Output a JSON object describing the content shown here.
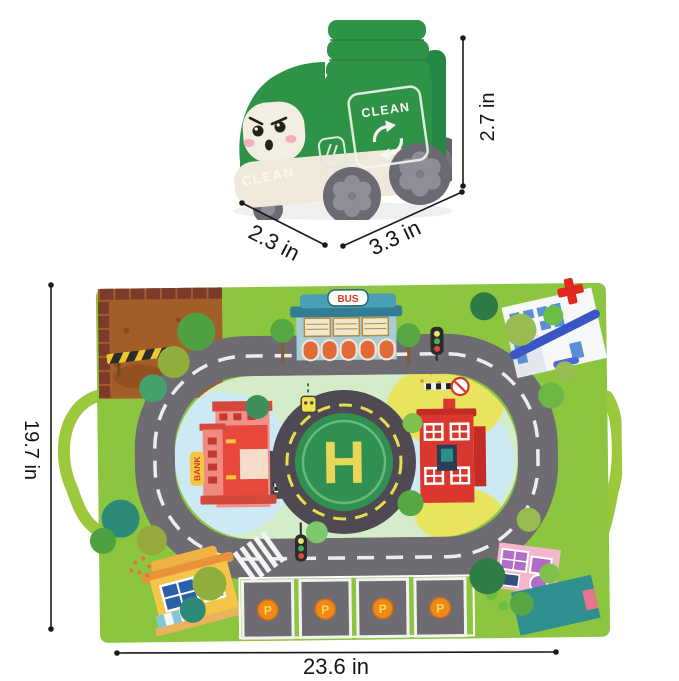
{
  "truck": {
    "front_label": "CLEAN",
    "panel_label": "CLEAN",
    "body_color": "#2E9247",
    "face_color": "#F3EEE2",
    "dims": {
      "height": "2.7 in",
      "depth": "2.3 in",
      "length": "3.3 in"
    }
  },
  "mat": {
    "signs": {
      "bus": "BUS",
      "bank": "BANK",
      "helipad": "H"
    },
    "parking_labels": [
      "P",
      "P",
      "P",
      "P"
    ],
    "colors": {
      "base": "#8CC63E",
      "road": "#6F6B73",
      "helipad_green": "#2F9052",
      "helipad_pad": "#4E4952",
      "helipad_letter": "#E9D75A",
      "handle": "#9CC83C"
    },
    "dims": {
      "height": "19.7 in",
      "width": "23.6 in"
    }
  },
  "annotation": {
    "line_color": "#1A1A1A"
  }
}
